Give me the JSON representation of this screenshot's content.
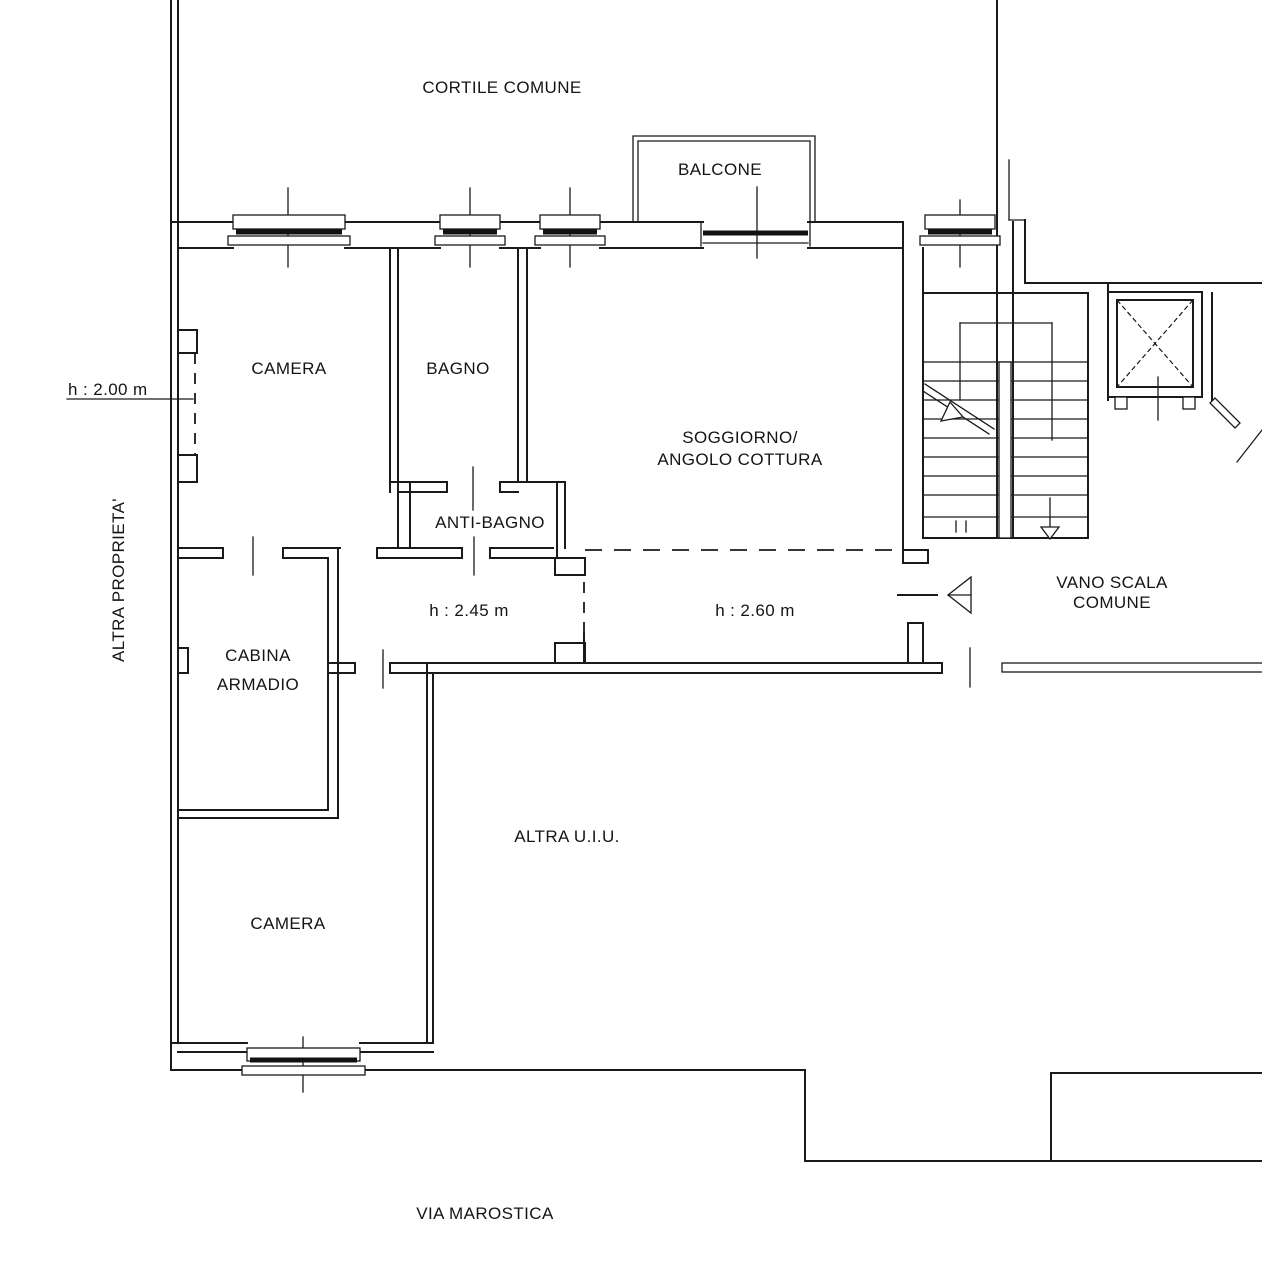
{
  "drawing": {
    "type": "architectural-floor-plan",
    "background": "#ffffff",
    "line_color": "#1a1a1a",
    "labels": {
      "cortile_comune": "CORTILE COMUNE",
      "balcone": "BALCONE",
      "camera_top": "CAMERA",
      "bagno": "BAGNO",
      "soggiorno_line1": "SOGGIORNO/",
      "soggiorno_line2": "ANGOLO COTTURA",
      "anti_bagno": "ANTI-BAGNO",
      "cabina_line1": "CABINA",
      "cabina_line2": "ARMADIO",
      "camera_bottom": "CAMERA",
      "altra_uiu": "ALTRA U.I.U.",
      "vano_scala_line1": "VANO SCALA",
      "vano_scala_line2": "COMUNE",
      "altra_proprieta": "ALTRA PROPRIETA'",
      "via_marostica": "VIA MAROSTICA",
      "height_camera": "h : 2.00 m",
      "height_corridor": "h : 2.45 m",
      "height_soggiorno": "h : 2.60 m"
    }
  }
}
